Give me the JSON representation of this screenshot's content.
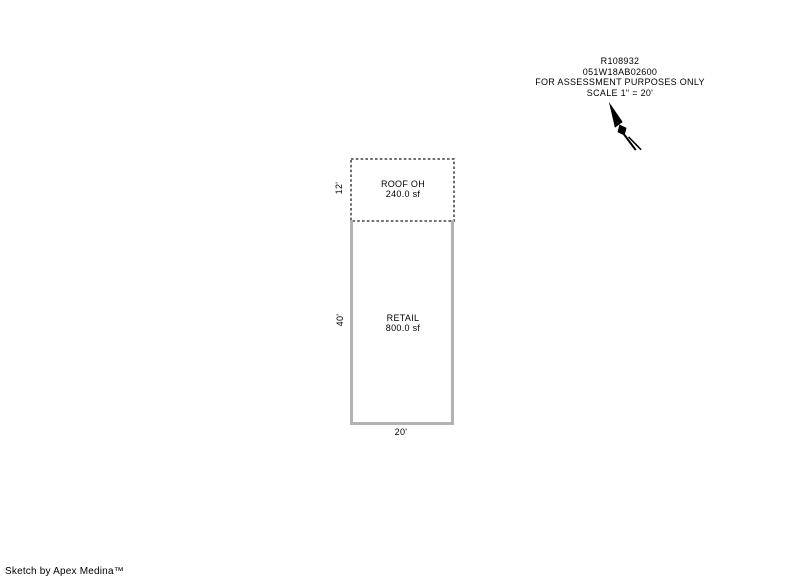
{
  "header": {
    "account_number": "R108932",
    "map_taxlot": "051W18AB02600",
    "notice": "FOR ASSESSMENT PURPOSES ONLY",
    "scale": "SCALE 1\" = 20'"
  },
  "sketch": {
    "roof_overhang": {
      "label": "ROOF OH",
      "area": "240.0 sf",
      "depth": "12'"
    },
    "retail": {
      "label": "RETAIL",
      "area": "800.0 sf",
      "depth": "40'",
      "width": "20'"
    }
  },
  "icons": {
    "north_arrow": "north-arrow"
  },
  "footer": {
    "credit": "Sketch by Apex Medina™"
  },
  "colors": {
    "background": "#ffffff",
    "text": "#000000",
    "solid-outline": "#b2b2b2",
    "dashed-outline": "#6f6f6f"
  }
}
